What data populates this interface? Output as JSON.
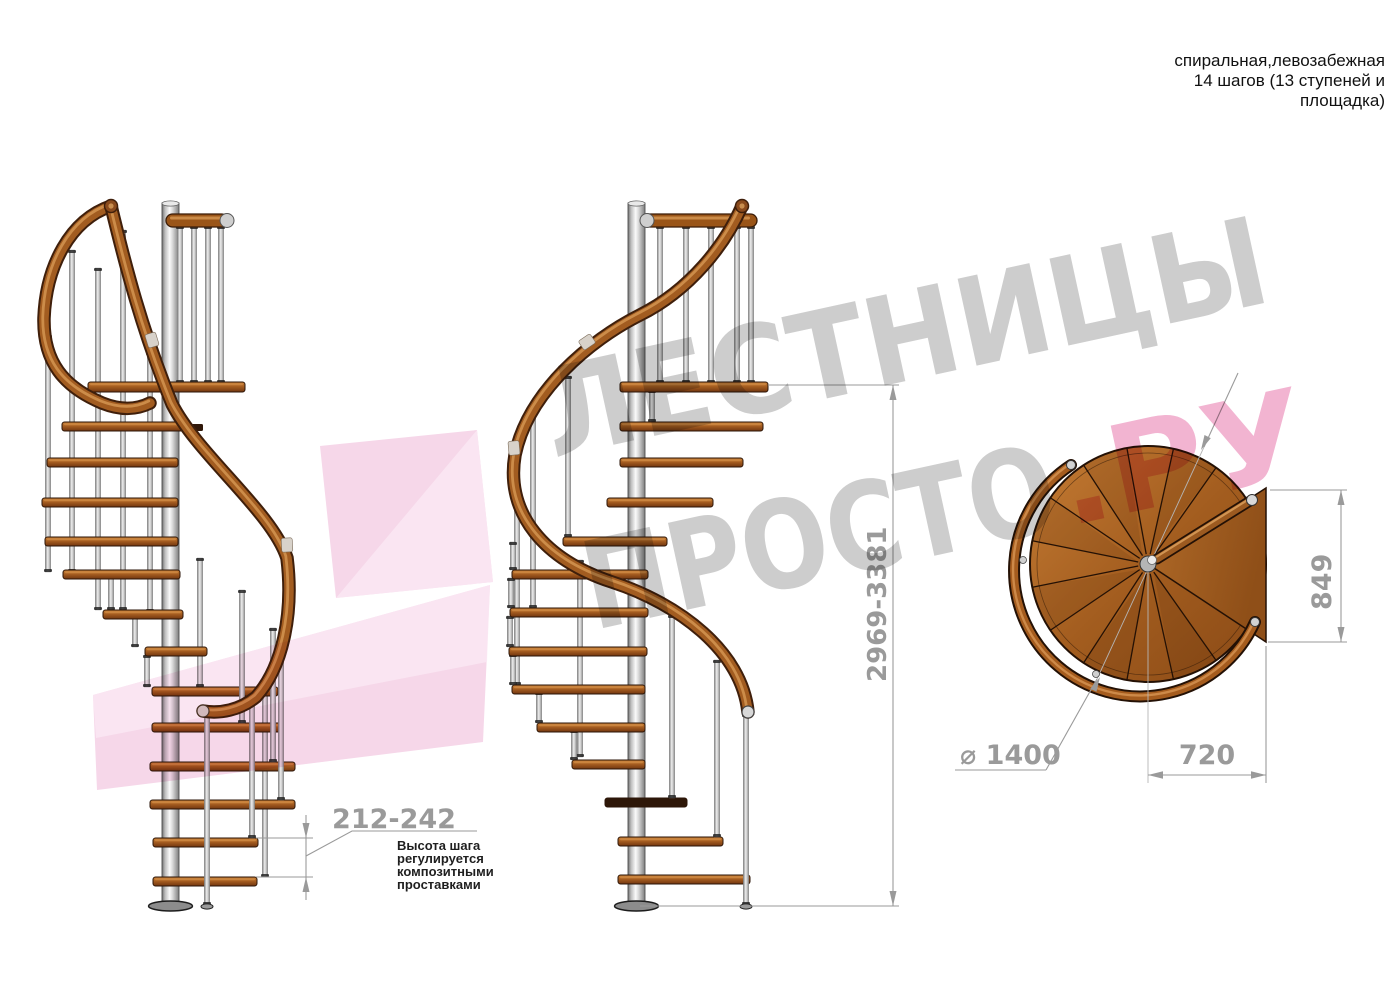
{
  "header": {
    "title_line1": "спиральная,левозабежная",
    "title_line2": "14 шагов (13 ступеней и",
    "title_line3": "площадка)"
  },
  "dimensions": {
    "total_height": "2969-3381",
    "step_height": "212-242",
    "diameter": "⌀ 1400",
    "plan_width": "720",
    "platform_length": "849"
  },
  "annotation": {
    "line1": "Высота шага",
    "line2": "регулируется",
    "line3": "композитными",
    "line4": "проставками"
  },
  "watermark": {
    "word1": "ЛЕСТНИЦЫ",
    "word2": "ПРОСТО",
    "word2_suffix": ".РУ",
    "text_gray": "#cdcdcd",
    "text_pink": "#f2b4d1",
    "logo_pink": "#f6d7e9",
    "logo_pink_light": "#fbe9f4"
  },
  "colors": {
    "wood_mid": "#a65e20",
    "wood_dark_outline": "#2b1508",
    "metal_light": "#d9d9d9",
    "dim_gray": "#9a9a9a",
    "note_text": "#1f1f1f",
    "title_text": "#111111"
  }
}
